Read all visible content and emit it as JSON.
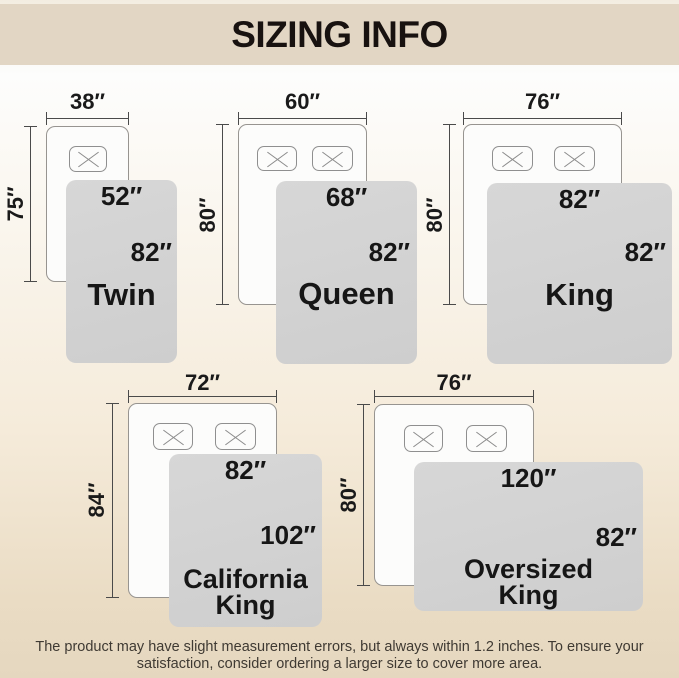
{
  "header": {
    "title": "SIZING INFO"
  },
  "diagrams": [
    {
      "name_line1": "Twin",
      "bed_width": "38″",
      "bed_length": "75″",
      "blanket_width": "52″",
      "blanket_length": "82″"
    },
    {
      "name_line1": "Queen",
      "bed_width": "60″",
      "bed_length": "80″",
      "blanket_width": "68″",
      "blanket_length": "82″"
    },
    {
      "name_line1": "King",
      "bed_width": "76″",
      "bed_length": "80″",
      "blanket_width": "82″",
      "blanket_length": "82″"
    },
    {
      "name_line1": "California",
      "name_line2": "King",
      "bed_width": "72″",
      "bed_length": "84″",
      "blanket_width": "82″",
      "blanket_length": "102″"
    },
    {
      "name_line1": "Oversized",
      "name_line2": "King",
      "bed_width": "76″",
      "bed_length": "80″",
      "blanket_width": "120″",
      "blanket_length": "82″"
    }
  ],
  "footer": {
    "line1": "The product may have slight measurement errors, but always within 1.2 inches. To ensure your",
    "line2": "satisfaction, consider ordering a larger size to cover more area."
  },
  "colors": {
    "header_band": "#e2d6c4",
    "blanket_gray": "#d3d3d3",
    "bed_white": "#fcfcfb",
    "label_text": "#1a1a1a",
    "footer_text": "#3f3a33"
  }
}
